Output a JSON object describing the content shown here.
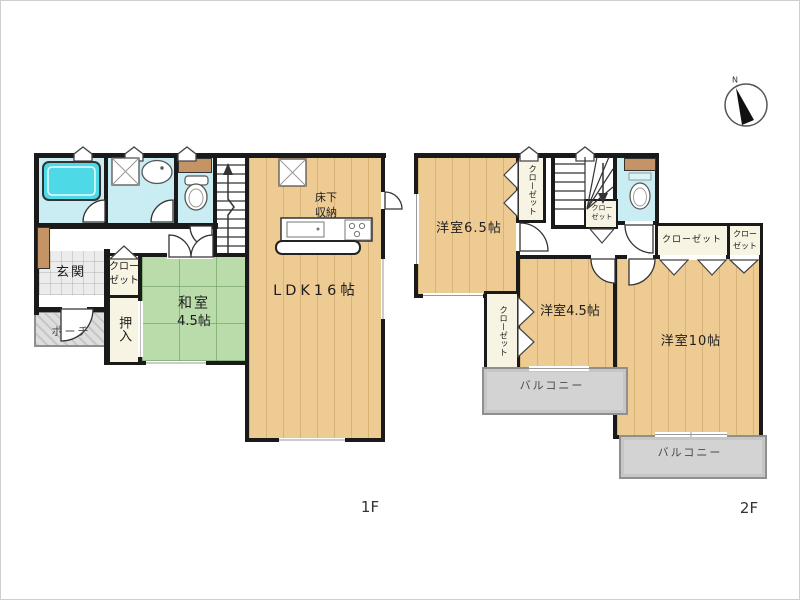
{
  "compass": {
    "north_label": "N"
  },
  "floor1": {
    "floor_label": "1F",
    "rooms": {
      "genkan": "玄関",
      "porch": "ポーチ",
      "closet_line1": "クロー",
      "closet_line2": "ゼット",
      "oshiire": "押入",
      "washitsu_line1": "和室",
      "washitsu_line2": "4.5帖",
      "ldk": "LDK16帖",
      "yukashita_line1": "床下",
      "yukashita_line2": "収納"
    }
  },
  "floor2": {
    "floor_label": "2F",
    "rooms": {
      "yoshitsu_65": "洋室6.5帖",
      "yoshitsu_45": "洋室4.5帖",
      "yoshitsu_10": "洋室10帖",
      "closet_65": "クローゼット",
      "closet_stairs_line1": "クロー",
      "closet_stairs_line2": "ゼット",
      "closet_main": "クローゼット",
      "closet_small_line1": "クロー",
      "closet_small_line2": "ゼット",
      "closet_45": "クローゼット",
      "balcony_south": "バルコニー",
      "balcony_east": "バルコニー"
    }
  },
  "colors": {
    "wall": "#1a1a1a",
    "wood_floor": "#edcb93",
    "tatami": "#b9dcaa",
    "water_room": "#c9edf3",
    "bathtub": "#4ed9e6",
    "closet_fill": "#f7f4e3",
    "balcony": "#d3d3d3",
    "tan_accent": "#c49466"
  }
}
